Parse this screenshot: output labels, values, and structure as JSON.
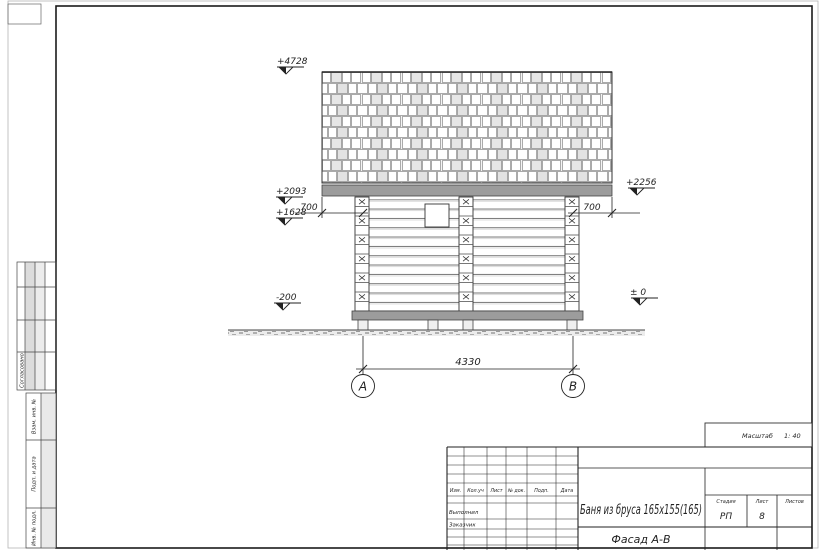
{
  "sheet": {
    "scale_label": "Масштаб",
    "scale_value": "1: 40",
    "stamp_side": {
      "agreed": "Согласовано",
      "replace_inv_no": "Взам. инв. №",
      "sign_and_date": "Подп. и дата",
      "inv_no_orig": "Инв. № подл."
    },
    "style_colors": {
      "ink": "#1f1f1f",
      "fill_gray": "#9c9c9c"
    }
  },
  "drawing": {
    "elevations": {
      "ridge": "+4728",
      "eaves_left": "+2093",
      "wall_top_left": "+1628",
      "eaves_right": "+2256",
      "base_left": "-200",
      "zero": "± 0"
    },
    "dims": {
      "overhang_left": "700",
      "overhang_right": "700",
      "span": "4330"
    },
    "axes": {
      "a": "А",
      "b": "В"
    }
  },
  "title_block": {
    "cols": [
      "Изм.",
      "Кол.уч",
      "Лист",
      "№ док.",
      "Подп.",
      "Дата"
    ],
    "roles": [
      "Выполнил",
      "Заказчик"
    ],
    "project_title": "Баня из бруса 165х155(165)",
    "view_title": "Фасад А-В",
    "stage_label": "Стадия",
    "stage_value": "РП",
    "sheet_label": "Лист",
    "sheet_value": "8",
    "sheets_label": "Листов",
    "sheets_value": ""
  }
}
